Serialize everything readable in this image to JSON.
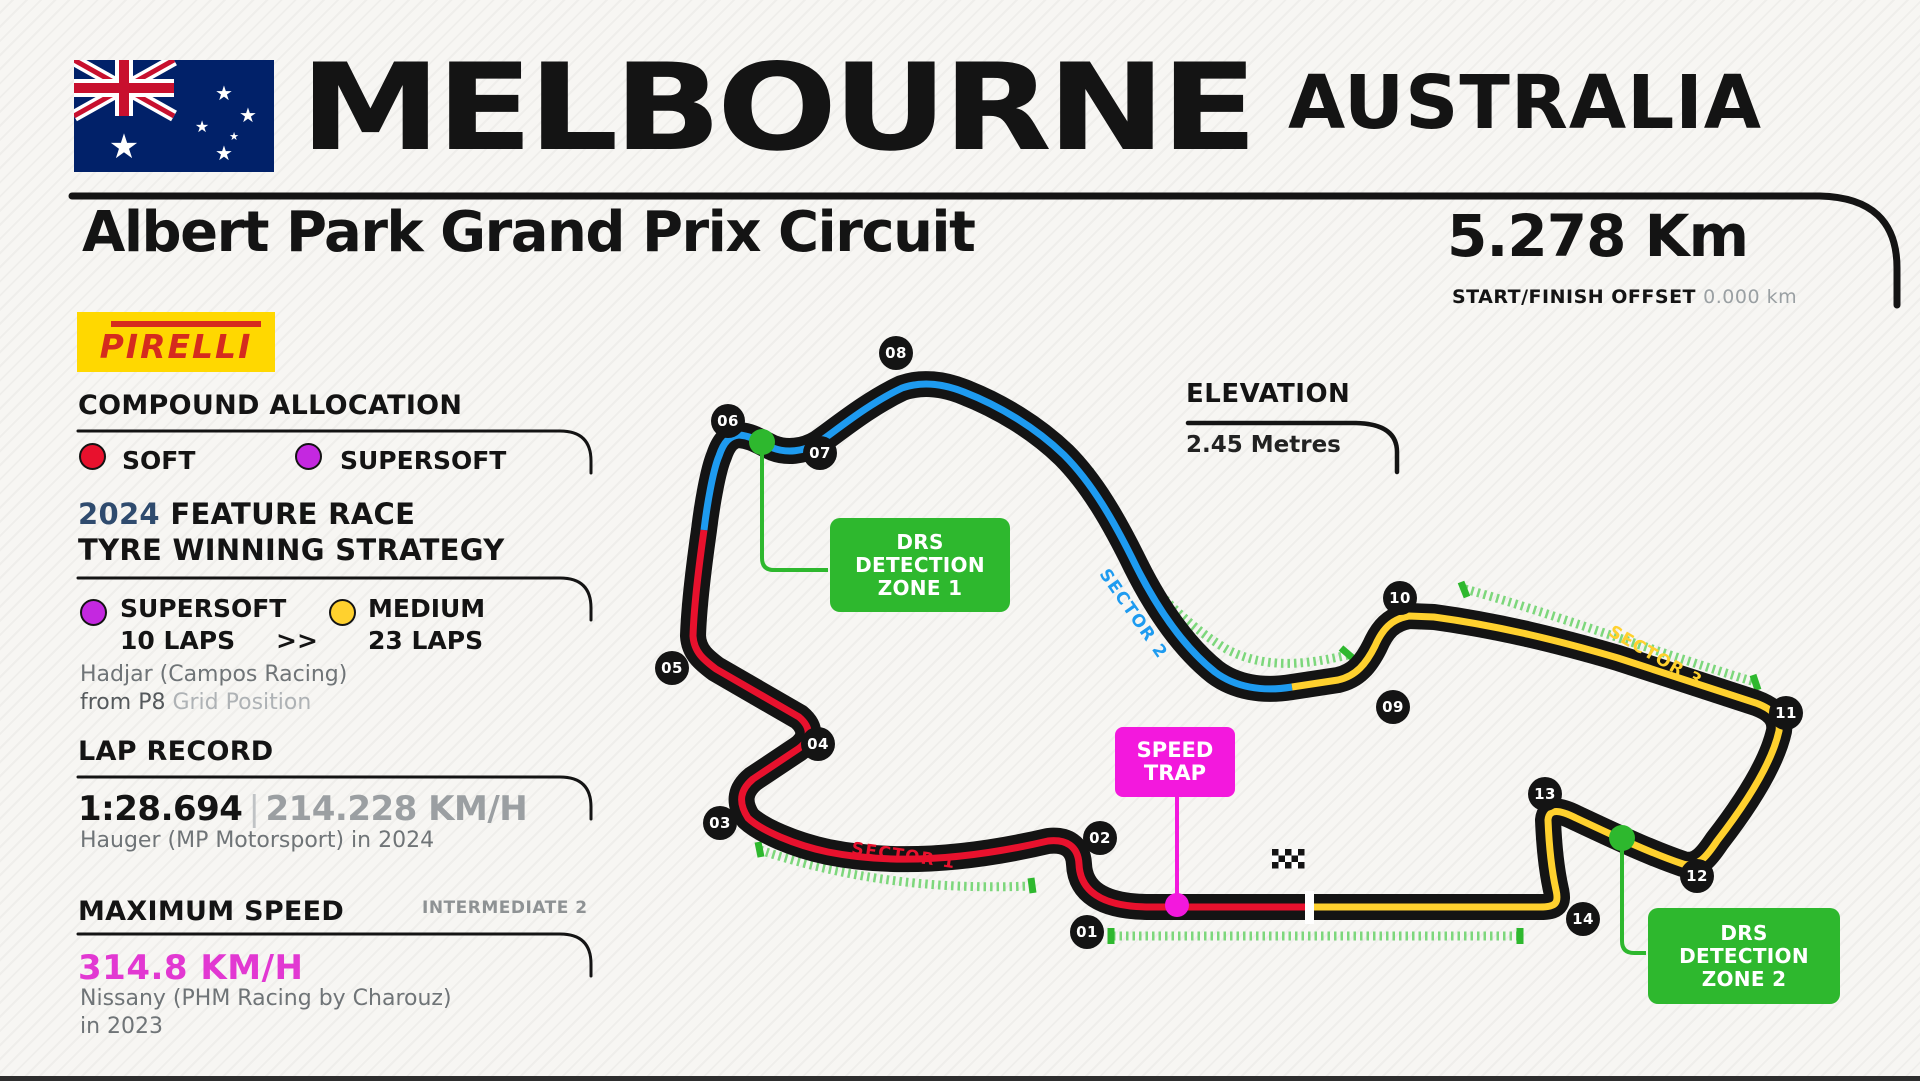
{
  "header": {
    "city": "MELBOURNE",
    "country": "AUSTRALIA"
  },
  "title_bar": {
    "circuit_name": "Albert Park Grand Prix Circuit",
    "length": "5.278 Km",
    "offset_label": "START/FINISH OFFSET",
    "offset_value": "0.000 km"
  },
  "sidebar": {
    "pirelli": "PIRELLI",
    "compound": {
      "heading": "COMPOUND ALLOCATION",
      "soft": "SOFT",
      "supersoft": "SUPERSOFT"
    },
    "strategy": {
      "year": "2024",
      "heading_rest": "FEATURE RACE",
      "heading_line2": "TYRE WINNING STRATEGY",
      "stint1_compound": "SUPERSOFT",
      "stint1_laps": "10 LAPS",
      "arrow": ">>",
      "stint2_compound": "MEDIUM",
      "stint2_laps": "23 LAPS",
      "driver": "Hadjar (Campos Racing)",
      "grid_prefix": "from P8",
      "grid_suffix": "Grid Position"
    },
    "lap_record": {
      "heading": "LAP RECORD",
      "time": "1:28.694",
      "divider": "|",
      "speed": "214.228 KM/H",
      "holder": "Hauger (MP Motorsport) in 2024"
    },
    "max_speed": {
      "heading": "MAXIMUM SPEED",
      "tag": "INTERMEDIATE 2",
      "value": "314.8 KM/H",
      "holder_line1": "Nissany (PHM Racing by Charouz)",
      "holder_line2": "in 2023"
    }
  },
  "map": {
    "elevation_heading": "ELEVATION",
    "elevation_value": "2.45 Metres",
    "speed_trap": {
      "line1": "SPEED",
      "line2": "TRAP"
    },
    "drs1": {
      "line1": "DRS",
      "line2": "DETECTION",
      "line3": "ZONE 1"
    },
    "drs2": {
      "line1": "DRS",
      "line2": "DETECTION",
      "line3": "ZONE 2"
    },
    "sector1": "SECTOR 1",
    "sector2": "SECTOR 2",
    "sector3": "SECTOR 3",
    "corners": [
      {
        "label": "01"
      },
      {
        "label": "02"
      },
      {
        "label": "03"
      },
      {
        "label": "04"
      },
      {
        "label": "05"
      },
      {
        "label": "06"
      },
      {
        "label": "07"
      },
      {
        "label": "08"
      },
      {
        "label": "09"
      },
      {
        "label": "10"
      },
      {
        "label": "11"
      },
      {
        "label": "12"
      },
      {
        "label": "13"
      },
      {
        "label": "14"
      }
    ]
  },
  "colors": {
    "sector1_red": "#e8112d",
    "sector2_blue": "#1e9bf0",
    "sector3_yellow": "#ffd12e",
    "soft_red": "#e8112d",
    "supersoft_purple": "#c428e0",
    "medium_yellow": "#ffd12e",
    "drs_green": "#2eb82e",
    "drs_dash_green": "#6fd46f",
    "speed_trap_magenta": "#f318dd",
    "max_speed_magenta": "#e238d2",
    "year_blue": "#2f4b6e",
    "pirelli_yellow": "#ffd800",
    "pirelli_red": "#d52b1e",
    "track_black": "#141414"
  }
}
